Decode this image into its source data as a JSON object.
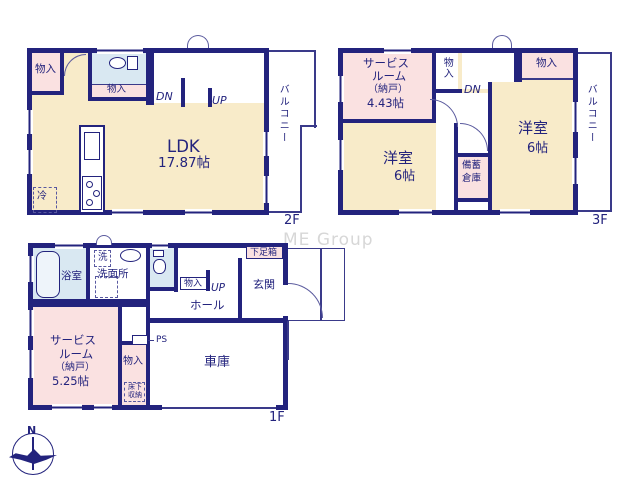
{
  "watermark": "ME Group",
  "compass": {
    "north": "N"
  },
  "floor2": {
    "label": "2F",
    "ldk": "LDK",
    "ldk_size": "17.87帖",
    "closet_tl": "物入",
    "closet_mid": "物入",
    "stairs_dn": "DN",
    "stairs_up": "UP",
    "balcony": "バルコニー",
    "fridge": "冷"
  },
  "floor3": {
    "label": "3F",
    "service_l1": "サービス",
    "service_l2": "ルーム",
    "service_l3": "（納戸）",
    "service_l4": "4.43帖",
    "closet_left": "物入",
    "closet_right": "物入",
    "stairs_dn": "DN",
    "west_room": "洋室",
    "west_room_size": "6帖",
    "east_room": "洋室",
    "east_room_size": "6帖",
    "storage_l1": "備蓄",
    "storage_l2": "倉庫",
    "balcony": "バルコニー"
  },
  "floor1": {
    "label": "1F",
    "bath": "浴室",
    "washer": "洗",
    "washroom": "洗面所",
    "stairs_up": "UP",
    "hall_closet": "物入",
    "hall": "ホール",
    "shoebox": "下足箱",
    "entrance": "玄関",
    "ps": "PS",
    "service_l1": "サービス",
    "service_l2": "ルーム",
    "service_l3": "（納戸）",
    "service_l4": "5.25帖",
    "closet": "物入",
    "underfloor_l1": "床下",
    "underfloor_l2": "収納",
    "garage": "車庫"
  },
  "colors": {
    "wall_navy": "#23237d",
    "room_cream": "#f8ebc9",
    "room_pink": "#fae1e1",
    "room_blue": "#d9e8f2",
    "watermark_gray": "#d7d7d7"
  }
}
